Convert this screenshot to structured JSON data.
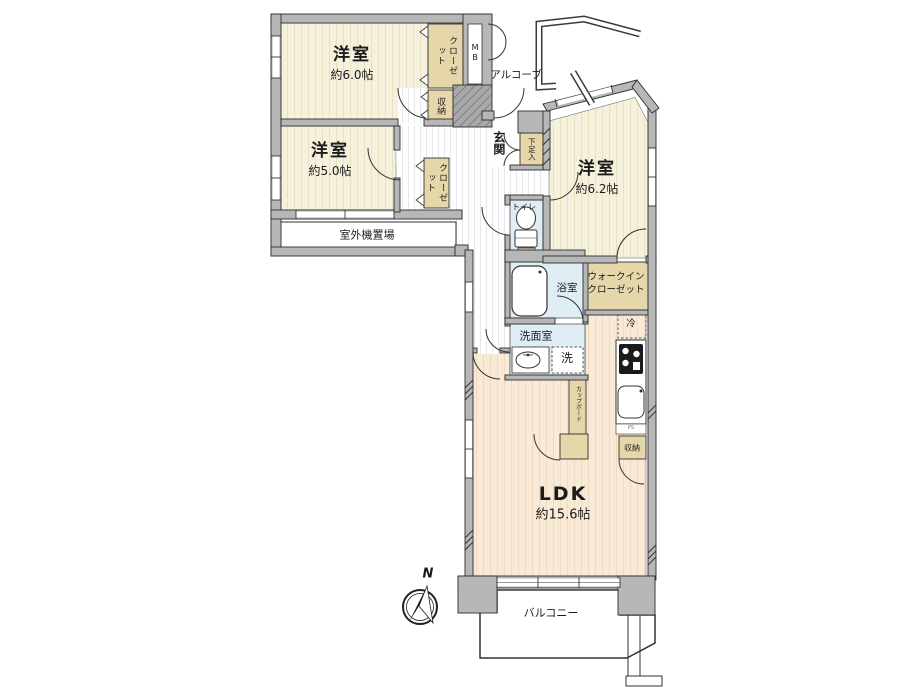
{
  "plan_type": "apartment-floor-plan",
  "colors": {
    "wall_gray": "#b7b7b7",
    "room_cream": "#f6f1dc",
    "ldk_peach": "#f8ead6",
    "closet_tan": "#e6d7ab",
    "wet_blue": "#dfeef5",
    "outline": "#2e2e2e"
  },
  "rooms": {
    "bedroom1": {
      "name": "洋室",
      "size": "約6.0帖"
    },
    "bedroom2": {
      "name": "洋室",
      "size": "約5.0帖"
    },
    "bedroom3": {
      "name": "洋室",
      "size": "約6.2帖"
    },
    "ldk": {
      "name": "LDK",
      "size": "約15.6帖"
    }
  },
  "labels": {
    "closet": "クローゼット",
    "storage": "収納",
    "walkin_line1": "ウォークイン",
    "walkin_line2": "クローゼット",
    "shoe_cabinet": "下足入",
    "cupboard": "カップボード",
    "meter_box": "MB",
    "pipe_space": "PS",
    "entrance": "玄関",
    "alcove": "アルコーブ",
    "toilet": "トイレ",
    "bathroom": "浴室",
    "washroom": "洗面室",
    "washer": "洗",
    "fridge": "冷",
    "outdoor_unit": "室外機置場",
    "balcony": "バルコニー",
    "north": "N"
  }
}
